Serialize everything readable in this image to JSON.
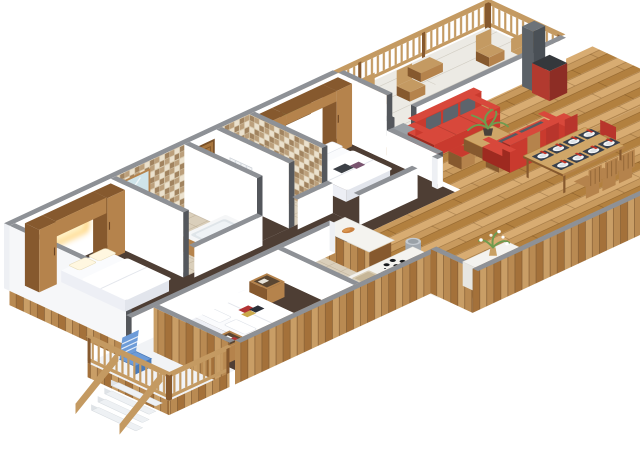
{
  "scene": {
    "title": "isometric-3d-apartment-floor-plan-render",
    "background": "#ffffff",
    "rooms": [
      {
        "name": "bedroom-1",
        "floor": "dark-walnut",
        "items": [
          "double-bed-white-linen",
          "wardrobe-tower-left",
          "wardrobe-tower-right",
          "overbed-bridge-cabinet",
          "warm-headboard-light"
        ]
      },
      {
        "name": "bathroom-1",
        "floor": "beige-tile",
        "items": [
          "mosaic-tiled-wall",
          "wood-framed-mirror",
          "vanity-with-copper-basin",
          "orange-bowl",
          "bathtub-with-wood-panel"
        ]
      },
      {
        "name": "entry-corridor",
        "floor": "dark-walnut",
        "items": [
          "wooden-entry-door",
          "radiator"
        ]
      },
      {
        "name": "bathroom-2",
        "floor": "beige-tile",
        "items": [
          "mosaic-tiled-walls",
          "wooden-stool-with-copper-bowl"
        ]
      },
      {
        "name": "bedroom-2",
        "floor": "dark-walnut",
        "items": [
          "double-bed-white-linen",
          "wardrobe-wall-unit",
          "green-landscape-painting",
          "dark-pillows"
        ]
      },
      {
        "name": "bedroom-3",
        "floor": "dark-walnut",
        "items": [
          "double-bed-white-linen",
          "magazines-on-bed",
          "storage-crate-front",
          "storage-crate-back"
        ]
      },
      {
        "name": "kitchen",
        "floor": "beige-tile",
        "items": [
          "l-shaped-white-counter",
          "beige-sink-basin",
          "cooktop-4-black-burners",
          "island-bar-with-bread",
          "metal-trash-bin"
        ]
      },
      {
        "name": "living-room",
        "floor": "oak-planks",
        "items": [
          "red-sofa-back",
          "red-sofa-front",
          "gray-back-cushions",
          "wood-coffee-table",
          "potted-green-plant",
          "red-top-stool-1",
          "red-top-stool-2",
          "gray-flue",
          "red-wood-stove",
          "half-wall-to-balcony",
          "gray-step"
        ]
      },
      {
        "name": "dining-area",
        "floor": "oak-planks",
        "items": [
          "wood-dining-table",
          "eight-place-settings",
          "red-napkins",
          "wooden-chairs",
          "red-chairs",
          "counter-with-flower-vase"
        ]
      },
      {
        "name": "balcony-left",
        "floor": "white-deck",
        "items": [
          "blue-deck-chair",
          "wooden-railing",
          "exterior-stairs"
        ]
      },
      {
        "name": "balcony-right",
        "floor": "pale-deck",
        "items": [
          "wooden-railing-back",
          "wooden-railing-return",
          "folding-chair-1",
          "folding-chair-2",
          "low-table",
          "folding-chair-3",
          "garden-bench"
        ]
      }
    ],
    "colors": {
      "wallTop": "#8e9196",
      "wallFace": "#ffffff",
      "wallFaceL": "#eef0f4",
      "wallCut": "#54575c",
      "floorDark": "#4e3e34",
      "tileFloor": "#dacfbb",
      "tileLine": "#c3b59d",
      "oak": "#c89a5e",
      "oakL": "#d8ac72",
      "oakD": "#b2803f",
      "plankA": "#b98a52",
      "plankB": "#a4713a",
      "plankC": "#c99e66",
      "woodMid": "#b5834c",
      "woodDark": "#86592e",
      "woodLight": "#cfa668",
      "railWood": "#c49a62",
      "mosBg": "#d9cbb0",
      "mosA": "#bb9f7b",
      "mosB": "#ebe1cd",
      "mosC": "#a1835f",
      "sofaRed": "#c93a2e",
      "sofaRedD": "#9e2a20",
      "sofaRedT": "#d8483b",
      "cushion": "#5d646c",
      "linen": "#fafbfd",
      "linenSh": "#e2e5ec",
      "linenSd": "#edeff5",
      "glow": "#ffd98c",
      "painting": "#7fae6d",
      "blue": "#6d9bd8",
      "metal": "#c4cad0",
      "metalD": "#a2a9b0",
      "plant": "#6f9b4f",
      "pot": "#49413a",
      "plate": "#f5f7f9",
      "mat": "#39404c",
      "napkin": "#c23227",
      "chairRed": "#b8352c",
      "balconyFloor": "#eceae4",
      "balconyLeft": "#f1f3f6",
      "copper": "#c07a45",
      "bowlOr": "#d98a3f",
      "mirror": "#cfe4ea",
      "doorWood": "#a9773f",
      "doorFrame": "#7a5128",
      "stoveRed": "#b23a2f",
      "flue": "#5b6167",
      "stepGray": "#9aa0a5",
      "counter": "#f4f3ef",
      "counterSide": "#e7e6e1",
      "tread": "#eef1f4",
      "treadSide": "#dfe3e7",
      "bread": "#c87f3e"
    }
  }
}
